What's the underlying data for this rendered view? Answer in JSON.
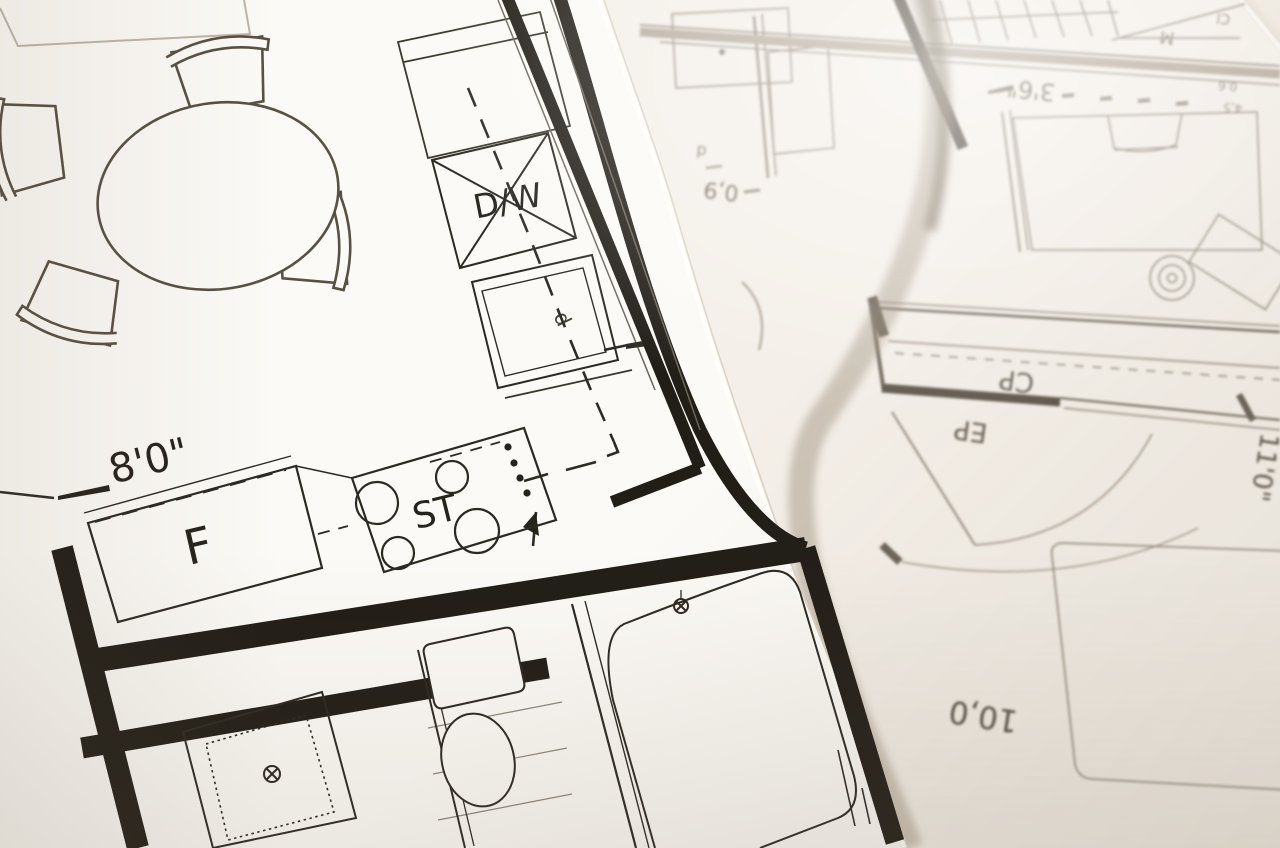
{
  "scene": {
    "description": "Photograph of two overlapping architectural floor-plan sheets viewed at an angle; sharp kitchen/bath plan on top-left sheet, blurred bedroom/closet plan on the sheet underneath"
  },
  "palette": {
    "paper_top": "#fcfaf6",
    "paper_under": "#f4efe8",
    "ink": "#29251f",
    "ink_faded": "#8d8478",
    "shadow": "#93866f"
  },
  "top_sheet": {
    "labels": {
      "dishwasher": "D/W",
      "sink_dim": "d",
      "fridge": "F",
      "stove": "ST"
    },
    "dimensions": {
      "kitchen_width": "8'0\""
    }
  },
  "under_sheet": {
    "labels": {
      "closet": "CP",
      "electrical_panel": "EP",
      "tile_label_m": "M",
      "tile_label_cl": "Cl",
      "fixture_d": "d"
    },
    "dimensions": {
      "bedroom_width": "11'0\"",
      "bedroom_length": "10,0",
      "door_width": "0,9",
      "window_width": "3'6\"",
      "small_dim_a": "0,6",
      "small_dim_b": "4,5"
    }
  }
}
